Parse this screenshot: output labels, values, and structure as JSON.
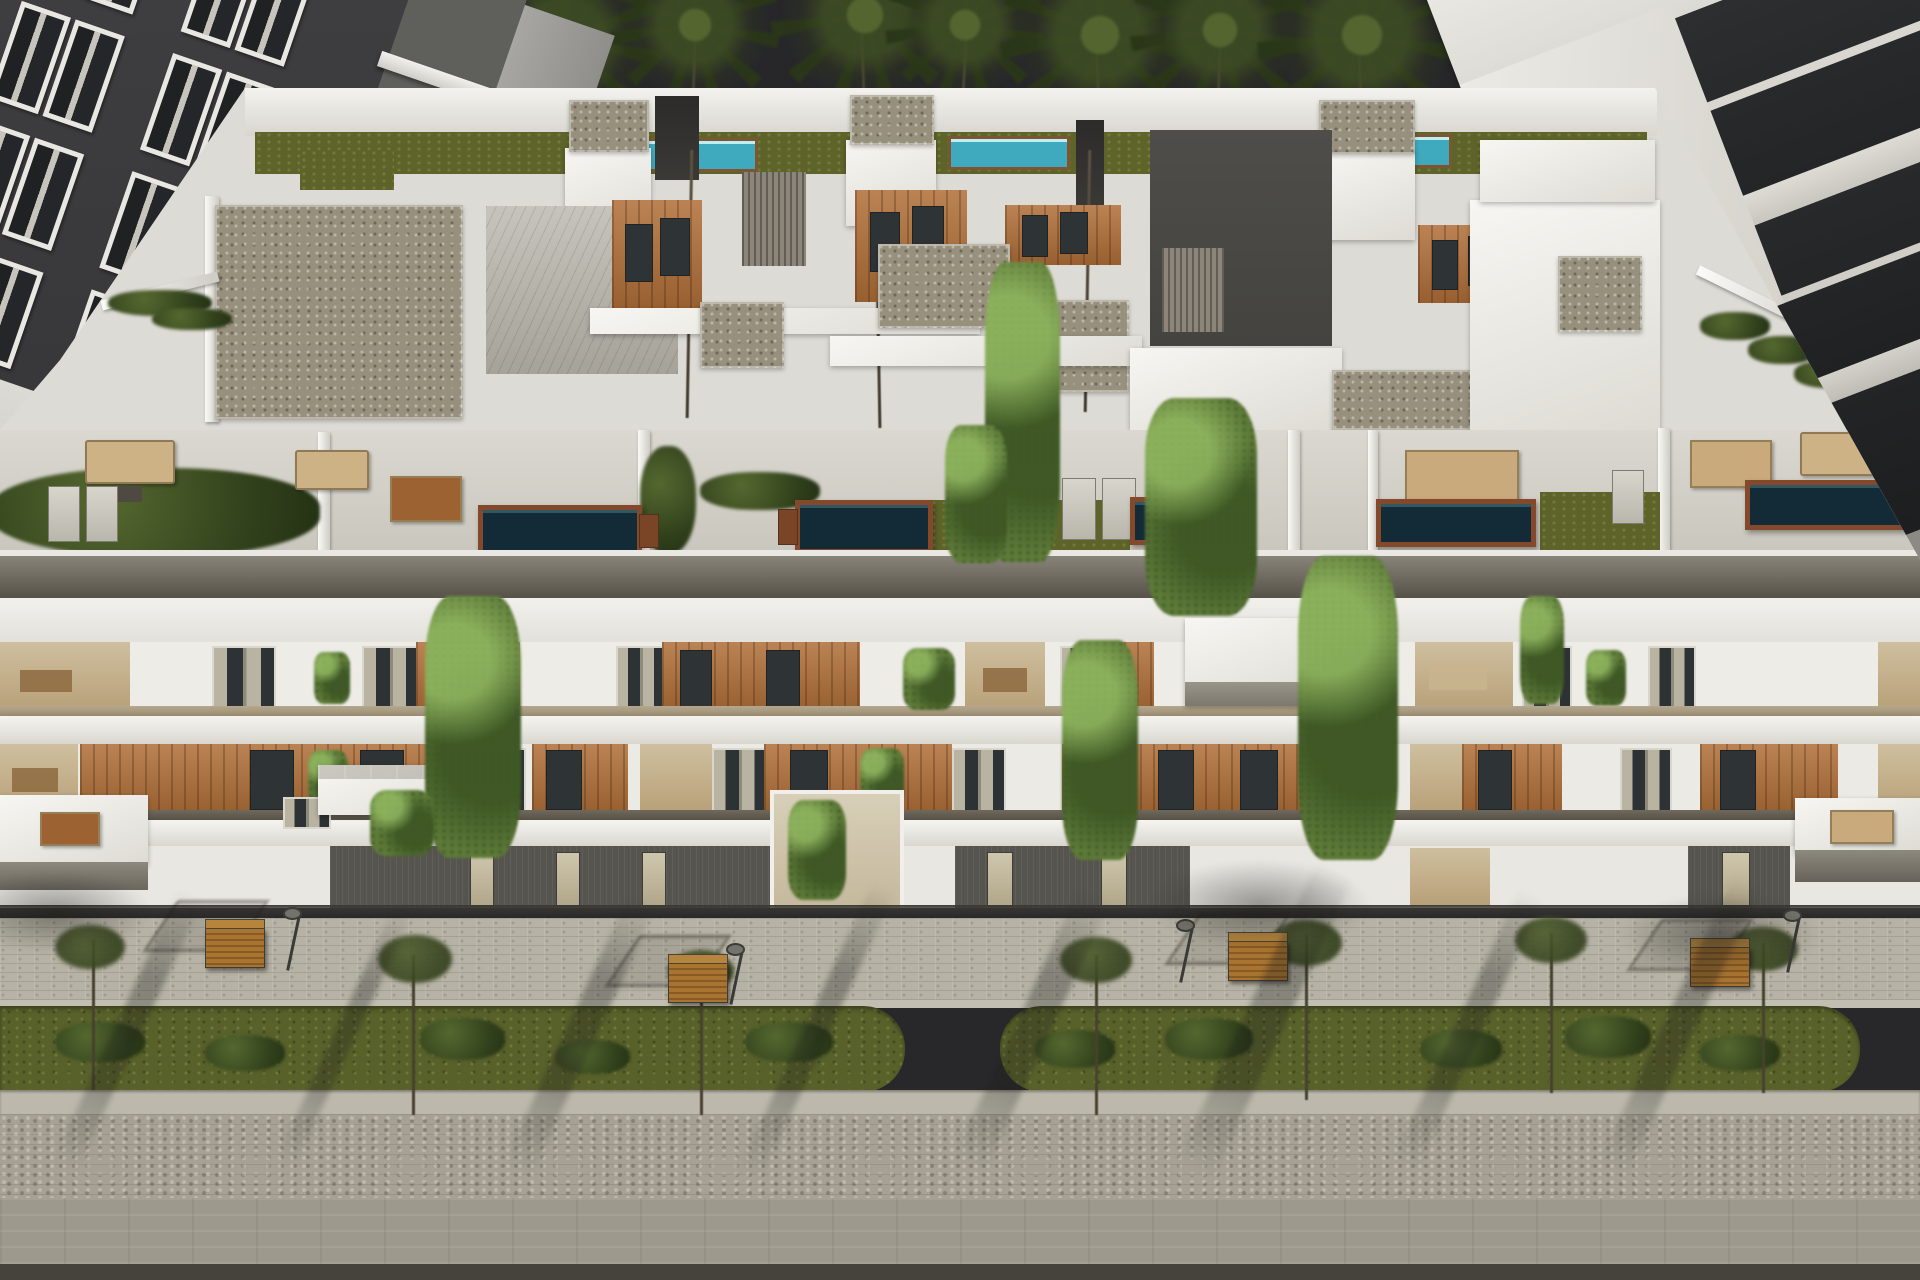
{
  "scene": {
    "description": "Aerial dusk 3D architectural rendering of a modern white apartment complex with rooftop pool terraces, wood-accented balconies, hanging ivy, palm trees behind, and a landscaped paved street with benches in front",
    "time_of_day": "dusk",
    "palette": {
      "sky": "#27272a",
      "building_white": "#efeeea",
      "wood_accent": "#b06f38",
      "ivy_green": "#5d7a38",
      "hedge_green": "#31411c",
      "lawn_olive": "#5e6429",
      "street_grass": "#59612a",
      "terrace_pool_water": "#122b37",
      "lap_pool_water": "#3fa9bd",
      "pool_deck_wood": "#83492a",
      "gravel_roof": "#97907d",
      "sidewalk_pavers": "#b6b2a5",
      "rough_pavers": "#a6a194",
      "road": "#9d998d",
      "dark_cladding": "#55544e",
      "neighbor_left_facade": "#3b3b3d",
      "neighbor_right_glass": "#2b2d2f",
      "bench_wood": "#a8742f"
    },
    "counts": {
      "palm_trees": 10,
      "rooftop_lap_pools": 3,
      "terrace_plunge_pools": 5,
      "stair_bulkheads": 3,
      "facade_floor_bands": 3,
      "ivy_columns": 7,
      "street_benches": 4,
      "street_lamps": 4,
      "street_grass_strips": 2,
      "street_trees": 7,
      "neighbor_buildings": 2
    },
    "objects": {
      "main_building": "white multi-level apartment block with stepped penthouse volumes, gravel and green roofs, rooftop terraces with furniture and plunge pools",
      "left_neighbor": "dark charcoal apartment block with white framed windows and stacked white balconies",
      "right_neighbor": "white apartment block with dark glass balcony bands and hedge planters",
      "street": "paved promenade with pergola benches, lamp posts, olive green planting strips, rough paver band and asphalt-toned road",
      "shadows": "long diagonal palm and tree shadows across the pavement"
    }
  }
}
